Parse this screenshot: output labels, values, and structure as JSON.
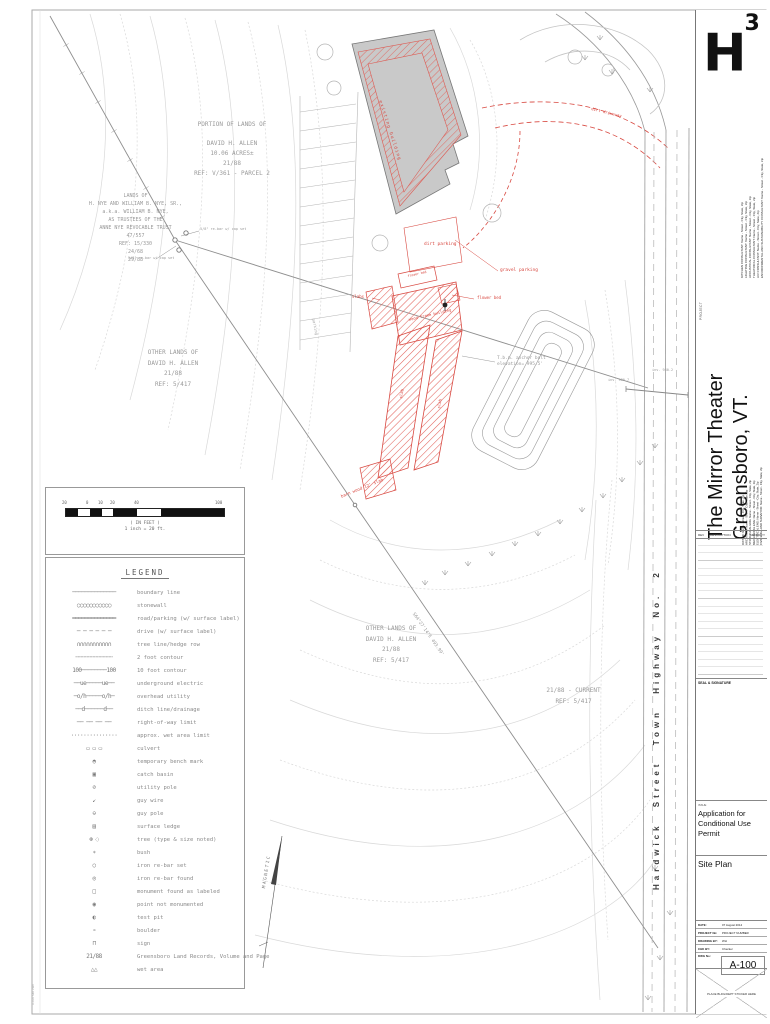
{
  "colors": {
    "accent_red": "#d84840",
    "building_gray": "#c9c9c9",
    "line_gray": "#9a9a9a"
  },
  "titleblock": {
    "logo_h": "H",
    "logo_sup": "3",
    "project_label": "PROJECT",
    "project_title": [
      "The Mirror Theater",
      "Greensboro, VT."
    ],
    "consultants": [
      "KITCHEN CONSULTANT: Name - Street - City, State, Zip",
      "LIGHTING CONSULTANT: Name - Street - City, State, Zip",
      "ACOUSTICAL CONSULTANT: Name - Street - City, State, Zip",
      "THEATRICAL CONSULTANT: Name - Street - City, State, Zip",
      "A/V CONSULTANT: Name - Street - City, State, Zip",
      "ENVIRONMENTAL AND SUSTAINABILITY CONSULTANT: Name - Street - City, State, Zip"
    ],
    "team": [
      "OWNER: Name - Street - City, State, Zip",
      "ARCHITECT: Name - Street - City, State, Zip",
      "STRUCTURAL ENG: Name - Street - City, State, Zip",
      "MECHANICAL ENG: Name - Street - City, State, Zip",
      "ELECTRICAL ENG: Name - Street - City, State, Zip",
      "CIVIL ENG/LAND SURVEYOR: Name - Street - City, State, Zip"
    ],
    "rev_table": {
      "rev": "REV",
      "description": "DESCRIPTION",
      "date": "MM/DD/YY"
    },
    "seal_label": "SEAL & SIGNATURE",
    "issue_label": "ISSUE",
    "issue_text": "Application for Conditional Use Permit",
    "sheet_title": "Site Plan",
    "fields": [
      {
        "label": "DATE:",
        "value": "07 August 2014"
      },
      {
        "label": "PROJECT No:",
        "value": "PROJECT NUMBER"
      },
      {
        "label": "DRAWING BY:",
        "value": "WH"
      },
      {
        "label": "CHK BY:",
        "value": "Checker"
      }
    ],
    "dwg_label": "DWG No:",
    "dwg_number": "A-100",
    "sticker_text": "PLACE BLDG/DEPT STICKER HERE"
  },
  "scalebar": {
    "ticks": [
      "20",
      "0",
      "10",
      "20",
      "40",
      "100"
    ],
    "caption_1": "( IN FEET )",
    "caption_2": "1 inch = 20 ft."
  },
  "legend": {
    "title": "LEGEND",
    "items": [
      {
        "glyph": "──────────────",
        "label": "boundary line"
      },
      {
        "glyph": "○○○○○○○○○○○",
        "label": "stonewall"
      },
      {
        "glyph": "══════════════",
        "label": "road/parking (w/ surface label)"
      },
      {
        "glyph": "─ ─ ─ ─ ─ ─",
        "label": "drive (w/ surface label)"
      },
      {
        "glyph": "∩∩∩∩∩∩∩∩∩∩∩",
        "label": "tree line/hedge row"
      },
      {
        "glyph": "╌╌╌╌╌╌╌╌╌╌╌╌",
        "label": "2 foot contour"
      },
      {
        "glyph": "100────────100",
        "label": "10 foot contour"
      },
      {
        "glyph": "──ue─────ue──",
        "label": "underground electric"
      },
      {
        "glyph": "─o/h─────o/h─",
        "label": "overhead utility"
      },
      {
        "glyph": "──d──────d──",
        "label": "ditch line/drainage"
      },
      {
        "glyph": "── ── ── ──",
        "label": "right-of-way limit"
      },
      {
        "glyph": "···············",
        "label": "approx. wet area limit"
      },
      {
        "glyph": "▭ ▭ ▭",
        "label": "culvert"
      },
      {
        "glyph": "◓",
        "label": "temporary bench mark"
      },
      {
        "glyph": "▣",
        "label": "catch basin"
      },
      {
        "glyph": "⊘",
        "label": "utility pole"
      },
      {
        "glyph": "↙",
        "label": "guy wire"
      },
      {
        "glyph": "⊖",
        "label": "guy pole"
      },
      {
        "glyph": "▤",
        "label": "surface ledge"
      },
      {
        "glyph": "⊛ ◌",
        "label": "tree (type & size noted)"
      },
      {
        "glyph": "∗",
        "label": "bush"
      },
      {
        "glyph": "○",
        "label": "iron re-bar set"
      },
      {
        "glyph": "◎",
        "label": "iron re-bar found"
      },
      {
        "glyph": "□",
        "label": "monument found as labeled"
      },
      {
        "glyph": "◉",
        "label": "point not monumented"
      },
      {
        "glyph": "◐",
        "label": "test pit"
      },
      {
        "glyph": "∘",
        "label": "boulder"
      },
      {
        "glyph": "⊓",
        "label": "sign"
      },
      {
        "glyph": "21/88",
        "label": "Greensboro Land Records, Volume and Page"
      },
      {
        "glyph": "△△",
        "label": "wet area"
      }
    ]
  },
  "plan": {
    "notes": {
      "parcel": [
        "PORTION OF LANDS OF",
        "DAVID H. ALLEN",
        "10.06 ACRES±",
        "21/88",
        "REF: V/361 - PARCEL 2"
      ],
      "lands": [
        "LANDS OF",
        "H. NYE AND WILLIAM B. NYE, SR.,",
        "a.k.a. WILLIAM B. NYE,",
        "AS TRUSTEES OF THE",
        "ANNE NYE REVOCABLE TRUST",
        "47/557",
        "REF: 15/330",
        "24/68",
        "29/88"
      ],
      "other_lands_a": [
        "OTHER LANDS OF",
        "DAVID H. ALLEN",
        "21/88",
        "REF: 5/417"
      ],
      "other_lands_b": [
        "OTHER LANDS OF",
        "DAVID H. ALLEN",
        "21/88",
        "REF: 5/417"
      ],
      "current": [
        "21/88 - CURRENT",
        "REF: 5/417"
      ],
      "tbm": [
        "T.b.m. anchor bolt",
        "elevation= 995.5'"
      ]
    },
    "labels": {
      "road": "Hardwick Street Town Highway No. 2",
      "bearing": "S64°27'14\"E 493.99'",
      "magnetic": "MAGNETIC",
      "parking": "parking",
      "inv_a": "inv. 980.7",
      "inv_b": "inv. 980.2",
      "pin_a": "5/8\" re-bar w/ cap set",
      "pin_b": "5/8\" re-bar w/ cap set",
      "edge_note": "A-100 Site Plan"
    },
    "red_labels": {
      "existing_building": "existing building",
      "dirt_parking": "dirt parking",
      "gravel_parking": "gravel parking",
      "flower_bed_a": "flower bed",
      "flower_bed_b": "flower bed",
      "slabs": "slabs",
      "wood_frame": "wood frame building",
      "slab_a": "slab",
      "slab_b": "slab",
      "barn": "barn wood 12' slab",
      "driveway": "dirt driveway"
    }
  }
}
